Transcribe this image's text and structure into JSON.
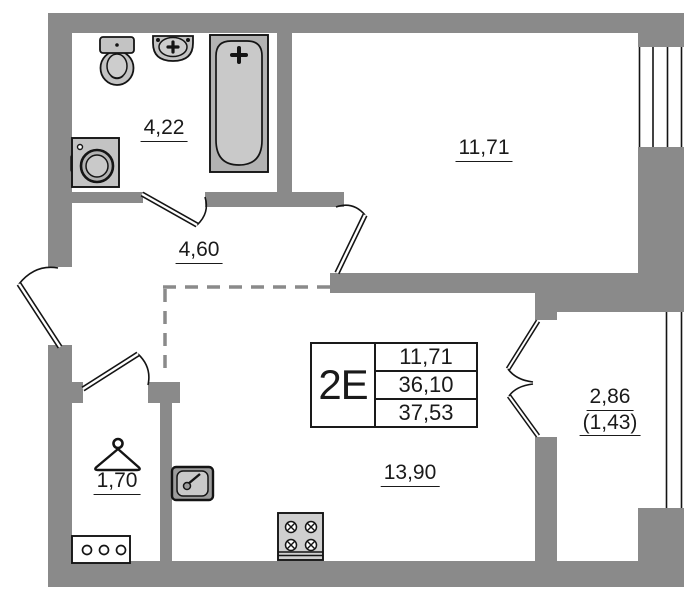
{
  "plan": {
    "title": "2E apartment floor plan",
    "colors": {
      "wall": "#8a8a8a",
      "dash": "#8a8a8a",
      "line": "#141414",
      "fixture": "#c3c3c3",
      "fixture_dark": "#b2b2b2",
      "fixture_light": "#cdcdcd"
    },
    "table": {
      "type_label": "2E",
      "rows": [
        "11,71",
        "36,10",
        "37,53"
      ]
    },
    "rooms": [
      {
        "name": "bathroom",
        "area": "4,22"
      },
      {
        "name": "living-room",
        "area": "11,71"
      },
      {
        "name": "hallway",
        "area": "4,60"
      },
      {
        "name": "closet",
        "area": "1,70"
      },
      {
        "name": "kitchen-living-room",
        "area": "13,90"
      },
      {
        "name": "balcony",
        "area": "2,86",
        "area_reduced": "(1,43)"
      }
    ]
  }
}
